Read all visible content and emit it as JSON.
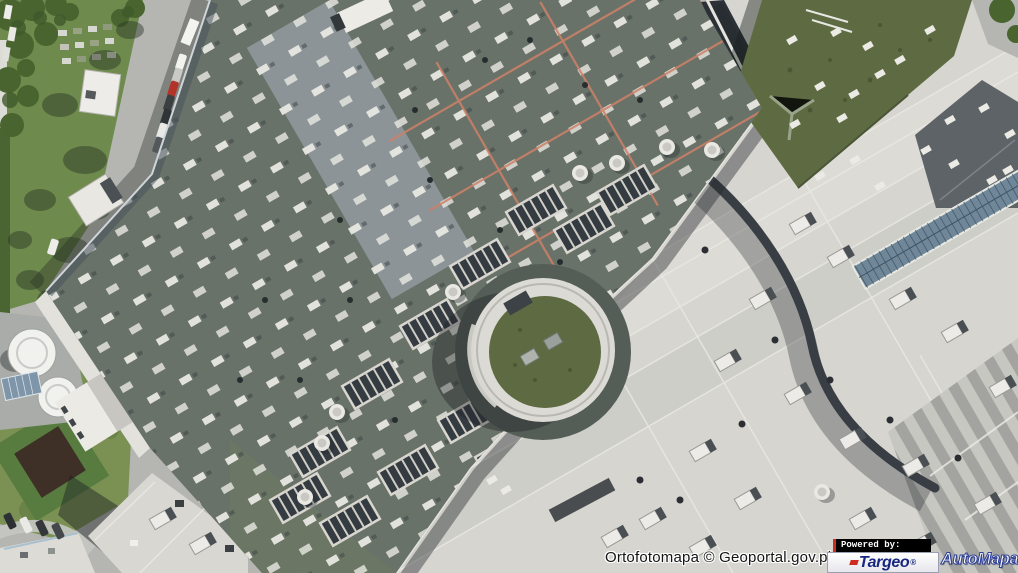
{
  "window": {
    "width": 1018,
    "height": 573
  },
  "map": {
    "kind": "aerial-orthophoto",
    "subject": "rooftops of a large shopping mall complex with skylight rows, safety lines, circular rotunda, green roof, storage tanks, access roads and parked cars",
    "attribution": "Ortofotomapa © Geoportal.gov.pl"
  },
  "branding": {
    "powered_by": "Powered by:",
    "targeo": {
      "name": "Targeo",
      "registered": "®"
    },
    "automapa": {
      "name": "AutoMapa",
      "registered": "®"
    }
  },
  "colors": {
    "road": "#b5b6b2",
    "roof_dark": "#697268",
    "roof_light": "#d6d5d0",
    "roof_slate": "#5d6367",
    "green_roof": "#5e6b42",
    "vegetation": "#6e8a4d",
    "tree": "#49642f",
    "lawn": "#7b9154",
    "safety_line": "#cf8168",
    "skylight": "#e9e8e2",
    "glass_strip": "#6f8798",
    "garden_dark": "#3e2f27",
    "tank_white": "#f1f1ee",
    "attribution_text": "#141414",
    "powered_by_bg": "#000000",
    "powered_by_text": "#ffffff",
    "accent_red": "#d02b20",
    "targeo_navy": "#17277f",
    "automapa_fill": "#fbfbfd",
    "automapa_outline": "#2e3f96"
  }
}
